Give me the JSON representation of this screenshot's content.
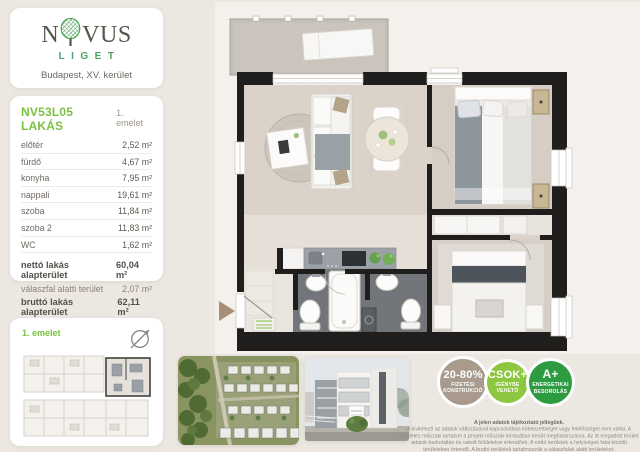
{
  "logo": {
    "word_left": "N",
    "word_right": "VUS",
    "subtitle": "LIGET",
    "location": "Budapest, XV. kerület"
  },
  "unit": {
    "title": "NV53L05 LAKÁS",
    "floor": "1. emelet",
    "rooms": [
      {
        "label": "előtér",
        "area": "2,52 m²"
      },
      {
        "label": "fürdő",
        "area": "4,67 m²"
      },
      {
        "label": "konyha",
        "area": "7,95 m²"
      },
      {
        "label": "nappali",
        "area": "19,61 m²"
      },
      {
        "label": "szoba",
        "area": "11,84 m²"
      },
      {
        "label": "szoba 2",
        "area": "11,83 m²"
      },
      {
        "label": "WC",
        "area": "1,62 m²"
      }
    ],
    "totals": [
      {
        "label": "nettó lakás alapterület",
        "area": "60,04 m²"
      },
      {
        "label": "válaszfal alatti terület",
        "area": "2,07 m²"
      },
      {
        "label": "bruttó lakás alapterület",
        "area": "62,11 m²"
      },
      {
        "label": "erkély",
        "area": "6,45 m²"
      }
    ],
    "sales_band": {
      "label": "ÉRTÉKESÍTÉSI TERÜLET",
      "area": "65,335 m²"
    }
  },
  "thumbnail": {
    "floor_label": "1. emelet"
  },
  "badges": [
    {
      "line1": "20-80%",
      "line2": "FIZETÉSI",
      "line3": "KONSTRUKCIÓ",
      "color": "#a89b8e"
    },
    {
      "line1": "CSOK+",
      "line2": "IGÉNYBE",
      "line3": "VEHETŐ",
      "color": "#8dc63f"
    },
    {
      "line1": "A+",
      "line2": "ENERGETIKAI",
      "line3": "BESOROLÁS",
      "color": "#2d9c41"
    }
  ],
  "disclaimer": {
    "title": "A jelen adatok tájékoztató jellegűek.",
    "body": "A kivitelező az adatok változásával kapcsolatban kötelezettséget vagy felelősséget nem vállal. A részletes műszaki tartalom a projekt műszaki leírásában került meghatározásra. Az itt megadott terület adatok burkolatlan és vakolt felületekre értendőek. A nettó területek a helyiségek falai közötti területeken értendő. A bruttó területek tartalmazzák a válaszfalak alatti területeket."
  },
  "colors": {
    "accent_green": "#7cc142",
    "logo_green": "#4aa568",
    "band_taupe": "#a2938a",
    "badge_taupe": "#a89b8e",
    "badge_light_green": "#8dc63f",
    "badge_dark_green": "#2d9c41",
    "wall_black": "#201e1c"
  }
}
